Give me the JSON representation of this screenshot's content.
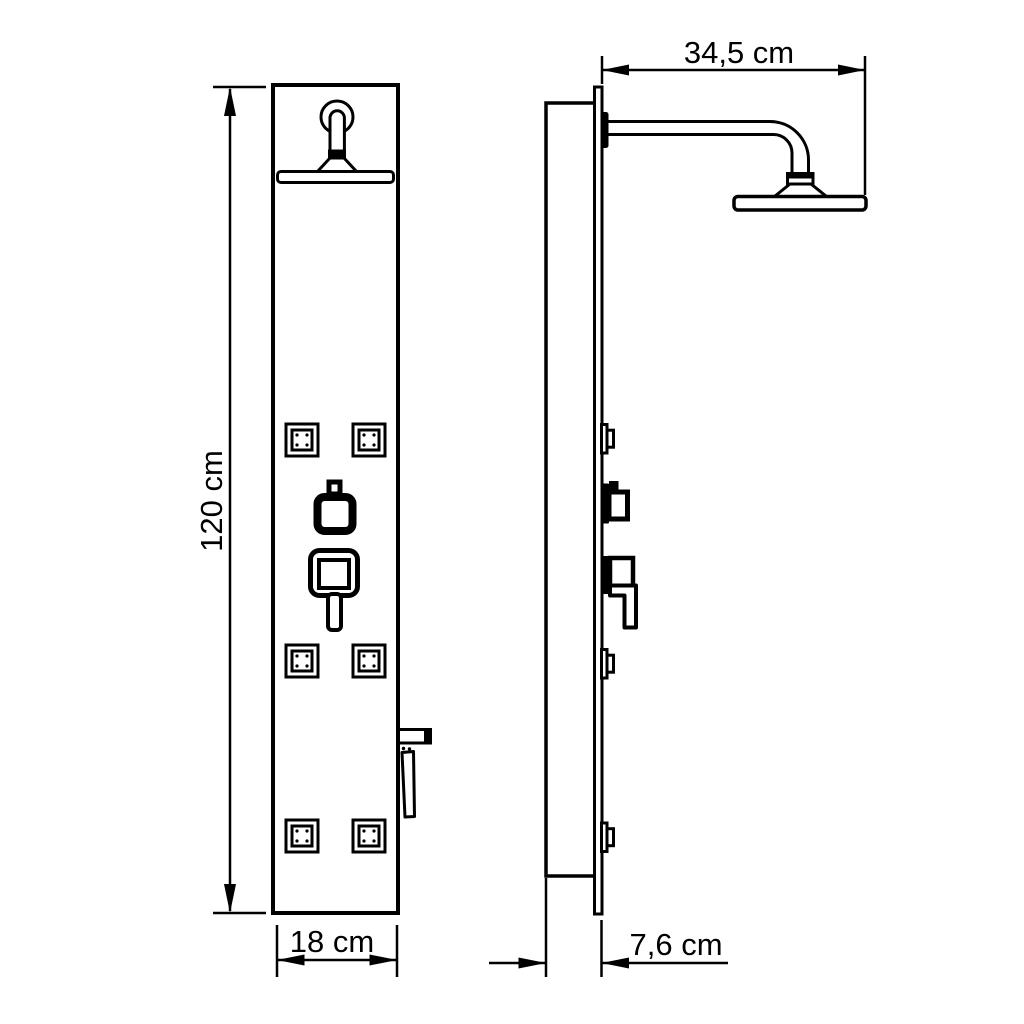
{
  "drawing": {
    "background_color": "#ffffff",
    "line_color": "#000000",
    "subject": "shower-panel-technical-drawing",
    "views": {
      "front": {
        "jet_count": 6
      },
      "side": {}
    },
    "dimensions": {
      "height": "120 cm",
      "width": "18 cm",
      "arm_reach": "34,5 cm",
      "depth": "7,6 cm"
    }
  }
}
